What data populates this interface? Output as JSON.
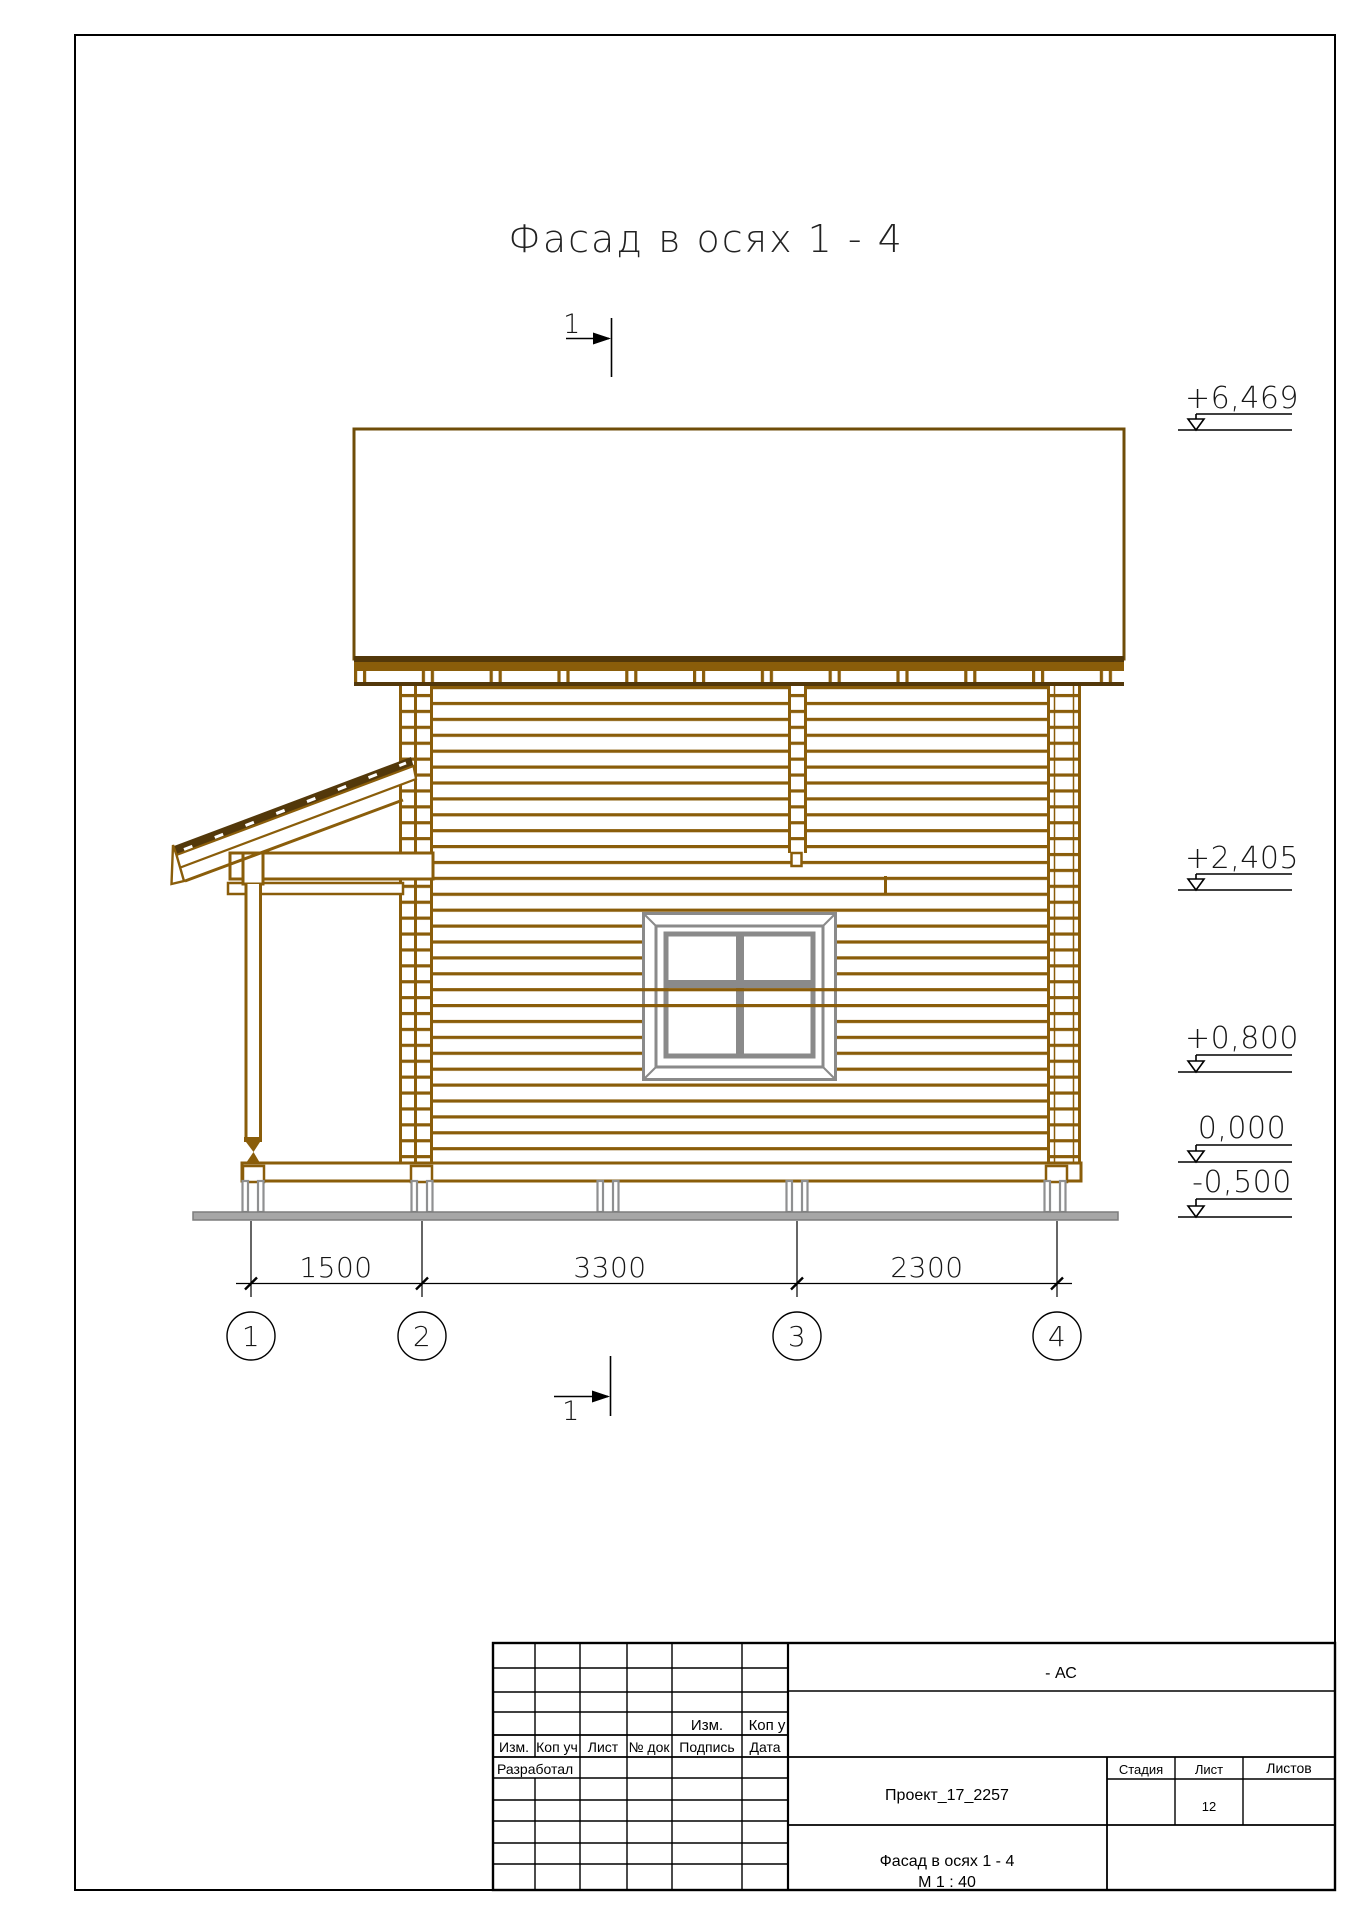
{
  "colors": {
    "log_brown": "#8a5d0a",
    "dark_brown": "#53380a",
    "roof_outline": "#6f4d08",
    "window_gray": "#8a8a8a",
    "foundation_gray": "#8f9091",
    "baseplate_gray": "#a6a6a6",
    "line_black": "#000000"
  },
  "drawing": {
    "title": "Фасад в осях 1 - 4",
    "section_mark_top": "1",
    "section_mark_bottom": "1",
    "elevations": [
      "+6,469",
      "+2,405",
      "+0,800",
      "0,000",
      "-0,500"
    ],
    "dimensions_mm": [
      "1500",
      "3300",
      "2300"
    ],
    "axes": [
      "1",
      "2",
      "3",
      "4"
    ]
  },
  "title_block": {
    "doc_code": "- АС",
    "project": "Проект_17_2257",
    "sheet_title": "Фасад в осях 1 - 4",
    "scale": "М 1 : 40",
    "stage_label": "Стадия",
    "sheet_label": "Лист",
    "sheets_label": "Листов",
    "sheet_number": "12",
    "upper_revision_headers": [
      "Изм.",
      "Коп у"
    ],
    "revision_headers": [
      "Изм.",
      "Коп уч",
      "Лист",
      "№ док",
      "Подпись",
      "Дата"
    ],
    "developer_label": "Разработал"
  }
}
